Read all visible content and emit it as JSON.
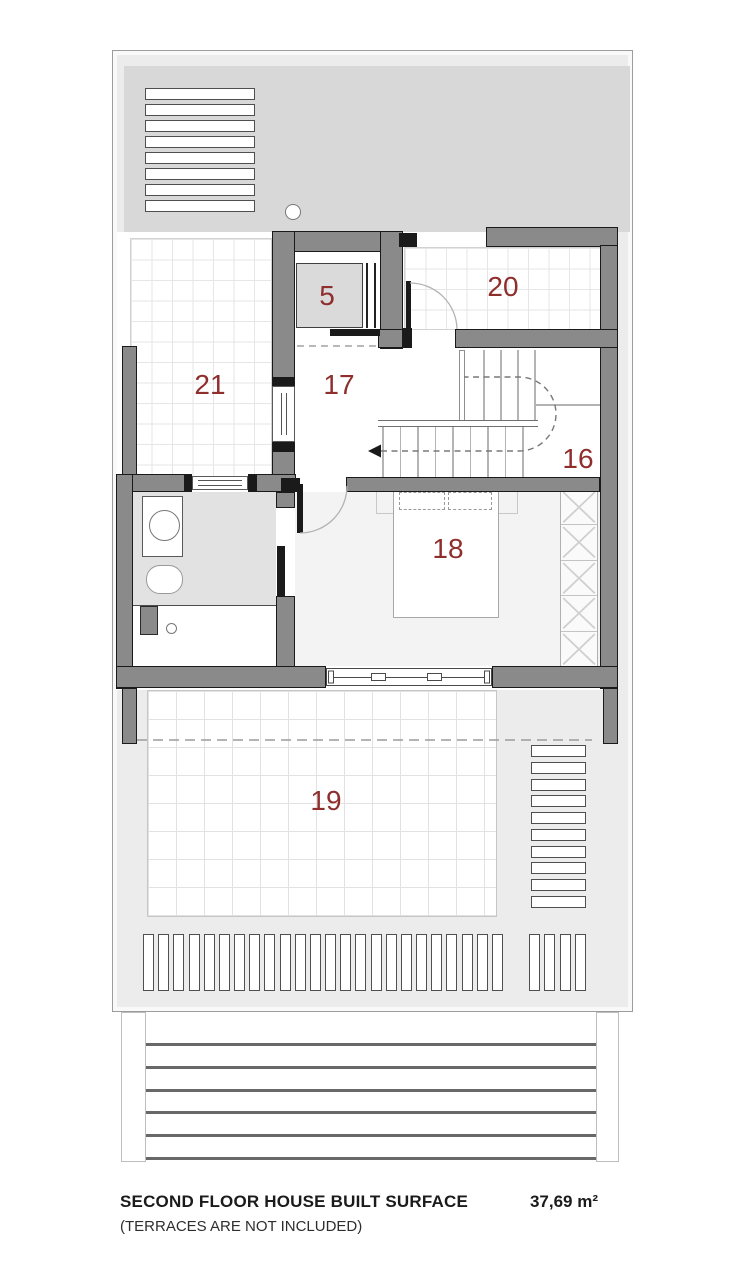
{
  "footer": {
    "title": "SECOND FLOOR HOUSE BUILT SURFACE",
    "subtitle": "(TERRACES ARE NOT INCLUDED)",
    "area_value": "37,69 m²"
  },
  "rooms": [
    {
      "label": "5",
      "x": 327,
      "y": 296
    },
    {
      "label": "20",
      "x": 503,
      "y": 287
    },
    {
      "label": "21",
      "x": 210,
      "y": 385
    },
    {
      "label": "17",
      "x": 339,
      "y": 385
    },
    {
      "label": "16",
      "x": 578,
      "y": 459
    },
    {
      "label": "18",
      "x": 448,
      "y": 549
    },
    {
      "label": "19",
      "x": 326,
      "y": 801
    }
  ],
  "colors": {
    "wall": "#8a8a8a",
    "wall_outline": "#1a1a1a",
    "label": "#8e2e2d",
    "plate": "#ececec",
    "band": "#d8d8d8"
  },
  "counts": {
    "louver_top_slats": 8,
    "louver_right_slats": 10,
    "bottom_slats_left": 24,
    "bottom_slats_right": 4,
    "wardrobe_cells": 5,
    "rail_lines": 6,
    "upper_treads": 4,
    "lower_treads": 9
  }
}
